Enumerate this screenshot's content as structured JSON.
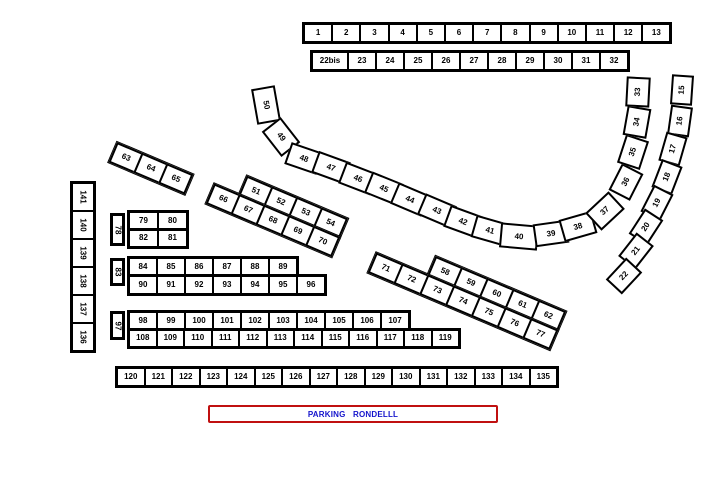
{
  "map": {
    "background": "#ffffff",
    "outline_color": "#000000"
  },
  "rows": {
    "top": [
      "1",
      "2",
      "3",
      "4",
      "5",
      "6",
      "7",
      "8",
      "9",
      "10",
      "11",
      "12",
      "13"
    ],
    "second": [
      "22bis",
      "23",
      "24",
      "25",
      "26",
      "27",
      "28",
      "29",
      "30",
      "31",
      "32"
    ],
    "bottom": [
      "120",
      "121",
      "122",
      "123",
      "124",
      "125",
      "126",
      "127",
      "128",
      "129",
      "130",
      "131",
      "132",
      "133",
      "134",
      "135"
    ]
  },
  "left_column": [
    "141",
    "140",
    "139",
    "138",
    "137",
    "136"
  ],
  "arcs": {
    "main": [
      "50",
      "49",
      "48",
      "47",
      "46",
      "45",
      "44",
      "43",
      "42",
      "41",
      "40",
      "39",
      "38",
      "37",
      "36",
      "35",
      "34",
      "33"
    ],
    "outer_right": [
      "15",
      "16",
      "17",
      "18",
      "19",
      "20",
      "21",
      "22"
    ]
  },
  "block_63": {
    "cells": [
      "63",
      "64",
      "65"
    ]
  },
  "block_51": {
    "top": [
      "51",
      "52",
      "53",
      "54"
    ],
    "bottom": [
      "66",
      "67",
      "68",
      "69",
      "70"
    ]
  },
  "block_58": {
    "top": [
      "58",
      "59",
      "60",
      "61",
      "62"
    ],
    "bottom": [
      "71",
      "72",
      "73",
      "74",
      "75",
      "76",
      "77"
    ]
  },
  "block_78": {
    "side": "78",
    "top": [
      "79",
      "80"
    ],
    "bottom": [
      "82",
      "81"
    ]
  },
  "block_83": {
    "side": "83",
    "top": [
      "84",
      "85",
      "86",
      "87",
      "88",
      "89"
    ],
    "bottom": [
      "90",
      "91",
      "92",
      "93",
      "94",
      "95",
      "96"
    ]
  },
  "block_97": {
    "side": "97",
    "top": [
      "98",
      "99",
      "100",
      "101",
      "102",
      "103",
      "104",
      "105",
      "106",
      "107"
    ],
    "bottom": [
      "108",
      "109",
      "110",
      "111",
      "112",
      "113",
      "114",
      "115",
      "116",
      "117",
      "118",
      "119"
    ]
  },
  "parking": {
    "label": "PARKING RONDELLL",
    "border_color": "#c01010",
    "text_color": "#1414cc"
  }
}
